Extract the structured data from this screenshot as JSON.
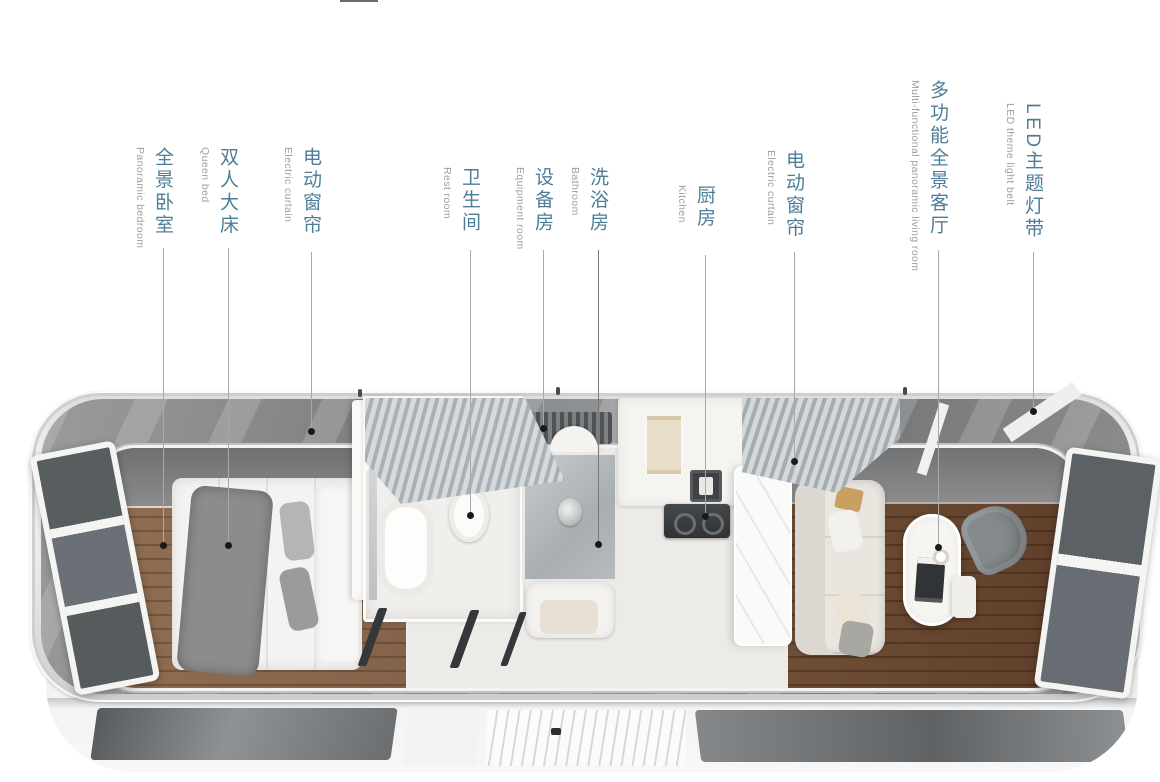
{
  "title": "capsule-house-floorplan-infographic",
  "colors": {
    "background": "#ffffff",
    "label_cn": "#4e7d98",
    "label_en": "#99a0a5",
    "leader_line": "#a9a9a9",
    "leader_dot": "#191919",
    "bedroom_wood": "#8a6950",
    "living_wood": "#6b4c36",
    "shell_silver": "#e8e8e8",
    "glass_gray": "#85878a"
  },
  "labels": [
    {
      "cn": "全景卧室",
      "en": "Panoramic bedroom"
    },
    {
      "cn": "双人大床",
      "en": "Queen bed"
    },
    {
      "cn": "电动窗帘",
      "en": "Electric curtain"
    },
    {
      "cn": "卫生间",
      "en": "Rest room"
    },
    {
      "cn": "设备房",
      "en": "Equipment room"
    },
    {
      "cn": "洗浴房",
      "en": "Bathroom"
    },
    {
      "cn": "厨房",
      "en": "Kitchen"
    },
    {
      "cn": "电动窗帘",
      "en": "Electric curtain"
    },
    {
      "cn": "多功能全景客厅",
      "en": "Multi-functional panoramic living room"
    },
    {
      "cn": "LED主题灯带",
      "en": "LED theme light belt"
    }
  ]
}
